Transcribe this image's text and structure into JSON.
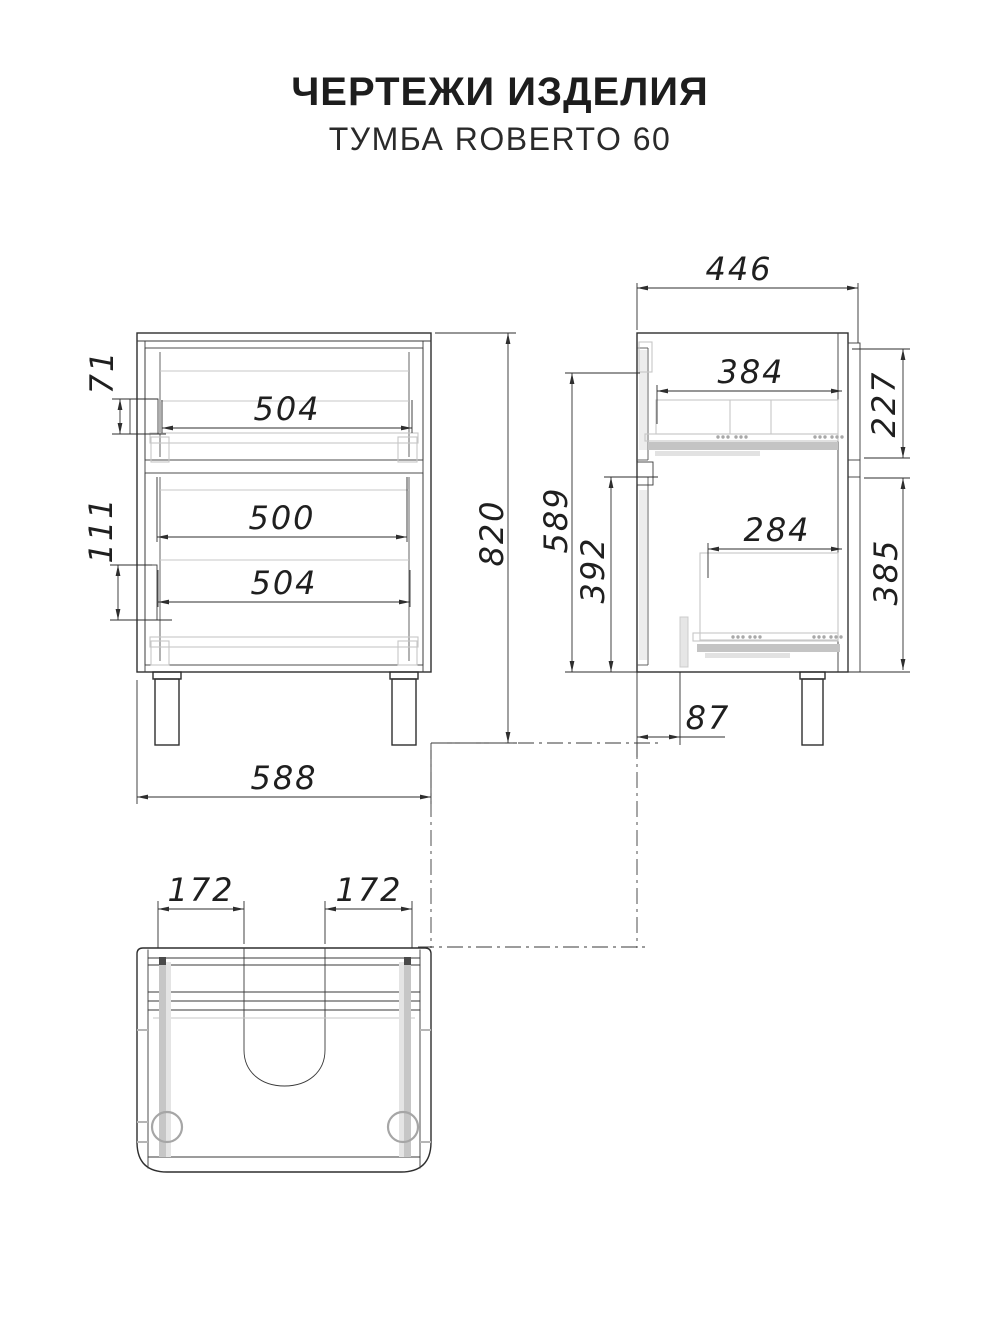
{
  "header": {
    "title": "ЧЕРТЕЖИ ИЗДЕЛИЯ",
    "subtitle": "ТУМБА ROBERTO 60"
  },
  "drawing": {
    "front_view": {
      "dims": {
        "top_drawer_width": "504",
        "middle_drawer_width": "500",
        "bottom_drawer_width": "504",
        "overall_height": "820",
        "overall_width": "588",
        "top_slide_offset": "71",
        "bottom_slide_offset": "111"
      }
    },
    "side_view": {
      "dims": {
        "overall_depth": "446",
        "top_drawer_depth": "384",
        "top_section_height": "227",
        "interior_height": "589",
        "lower_interior_height": "392",
        "bottom_drawer_depth": "284",
        "bottom_section_height": "385",
        "leg_front_offset": "87"
      }
    },
    "bottom_view": {
      "dims": {
        "left_slide_spacing": "172",
        "right_slide_spacing": "172"
      }
    }
  }
}
